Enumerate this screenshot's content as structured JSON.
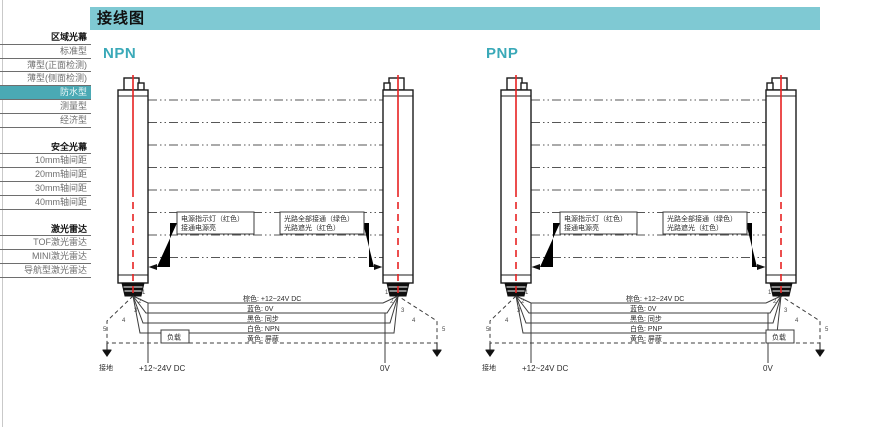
{
  "header": {
    "title": "接线图"
  },
  "colors": {
    "titlebar_bg": "#7fc9d3",
    "selected_bg": "#4aa9b4",
    "heading_teal": "#3aa9b8",
    "beam_red": "#e82222"
  },
  "sidebar": {
    "items": [
      {
        "label": "区域光幕",
        "type": "header",
        "selected": false
      },
      {
        "label": "标准型",
        "type": "item",
        "selected": false
      },
      {
        "label": "薄型(正面检测)",
        "type": "item",
        "selected": false
      },
      {
        "label": "薄型(侧面检测)",
        "type": "item",
        "selected": false
      },
      {
        "label": "防水型",
        "type": "item",
        "selected": true
      },
      {
        "label": "测量型",
        "type": "item",
        "selected": false
      },
      {
        "label": "经济型",
        "type": "item",
        "selected": false
      },
      {
        "label": "安全光幕",
        "type": "header",
        "selected": false
      },
      {
        "label": "10mm轴间距",
        "type": "item",
        "selected": false
      },
      {
        "label": "20mm轴间距",
        "type": "item",
        "selected": false
      },
      {
        "label": "30mm轴间距",
        "type": "item",
        "selected": false
      },
      {
        "label": "40mm轴间距",
        "type": "item",
        "selected": false
      },
      {
        "label": "激光雷达",
        "type": "header",
        "selected": false
      },
      {
        "label": "TOF激光雷达",
        "type": "item",
        "selected": false
      },
      {
        "label": "MINI激光雷达",
        "type": "item",
        "selected": false
      },
      {
        "label": "导航型激光雷达",
        "type": "item",
        "selected": false
      }
    ]
  },
  "npn": {
    "title": "NPN",
    "callout_power_line1": "电源指示灯（红色）",
    "callout_power_line2": "接通电源亮",
    "callout_status_line1": "光路全部接通（绿色）",
    "callout_status_line2": "光路遮光（红色）",
    "wire_brown": "棕色: +12~24V DC",
    "wire_blue": "蓝色: 0V",
    "wire_black": "黑色: 同步",
    "wire_white": "白色: NPN",
    "wire_yellow": "黄色: 屏蔽",
    "load": "负载",
    "ground": "接地",
    "supply": "+12~24V DC",
    "zero": "0V",
    "pin1": "1",
    "pin2": "2",
    "pin3": "3",
    "pin4": "4",
    "pin5": "5"
  },
  "pnp": {
    "title": "PNP",
    "callout_power_line1": "电源指示灯（红色）",
    "callout_power_line2": "接通电源亮",
    "callout_status_line1": "光路全部接通（绿色）",
    "callout_status_line2": "光路遮光（红色）",
    "wire_brown": "棕色: +12~24V DC",
    "wire_blue": "蓝色: 0V",
    "wire_black": "黑色: 同步",
    "wire_white": "白色: PNP",
    "wire_yellow": "黄色: 屏蔽",
    "load": "负载",
    "ground": "接地",
    "supply": "+12~24V DC",
    "zero": "0V",
    "pin1": "1",
    "pin2": "2",
    "pin3": "3",
    "pin4": "4",
    "pin5": "5"
  }
}
